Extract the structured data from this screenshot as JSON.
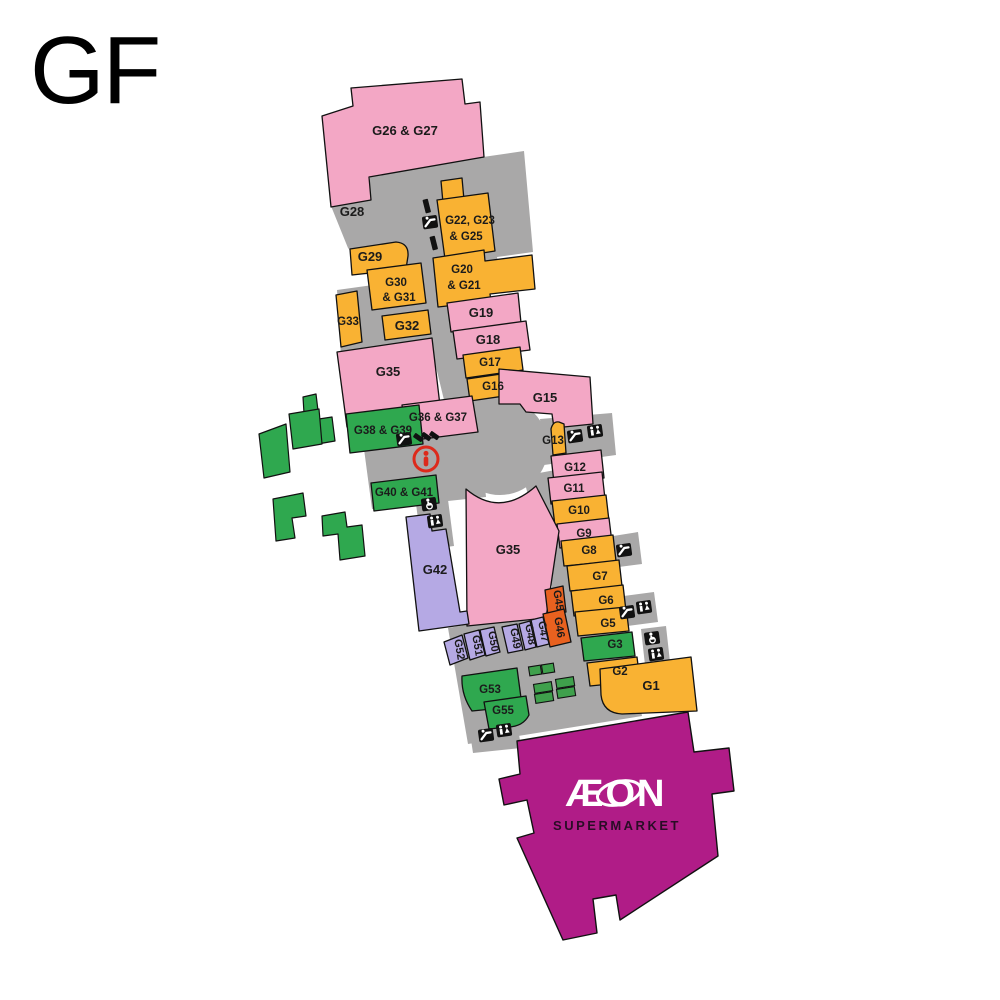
{
  "floor": {
    "label": "GF"
  },
  "anchor_store": {
    "name": "ÆON",
    "subtitle": "SUPERMARKET"
  },
  "units": {
    "g1": "G1",
    "g2": "G2",
    "g3": "G3",
    "g5": "G5",
    "g6": "G6",
    "g7": "G7",
    "g8": "G8",
    "g9": "G9",
    "g10": "G10",
    "g11": "G11",
    "g12": "G12",
    "g13": "G13",
    "g15": "G15",
    "g16": "G16",
    "g17": "G17",
    "g18": "G18",
    "g19": "G19",
    "g20_21_line1": "G20",
    "g20_21_line2": "& G21",
    "g22_25_line1": "G22, G23",
    "g22_25_line2": "& G25",
    "g26_27": "G26 & G27",
    "g28": "G28",
    "g29": "G29",
    "g30_31_line1": "G30",
    "g30_31_line2": "& G31",
    "g32": "G32",
    "g33": "G33",
    "g35_upper": "G35",
    "g35_lower": "G35",
    "g36_37": "G36 & G37",
    "g38_39": "G38 & G39",
    "g40_41": "G40 & G41",
    "g42": "G42",
    "g45": "G45",
    "g46": "G46",
    "g47": "G47",
    "g48": "G48",
    "g49": "G49",
    "g50": "G50",
    "g51": "G51",
    "g52": "G52",
    "g53": "G53",
    "g55": "G55"
  },
  "icons": {
    "escalator": "escalator",
    "restroom": "restroom",
    "accessible": "accessible-toilet",
    "information": "information"
  },
  "colors": {
    "unit_pink": "#F3A7C5",
    "unit_orange": "#F9B233",
    "unit_dark_orange": "#E8611F",
    "unit_green": "#2FA84F",
    "unit_purple": "#B5A9E4",
    "walkway_grey": "#A9A8A8",
    "anchor_magenta": "#B01C87",
    "info_red": "#DD2A1B"
  }
}
